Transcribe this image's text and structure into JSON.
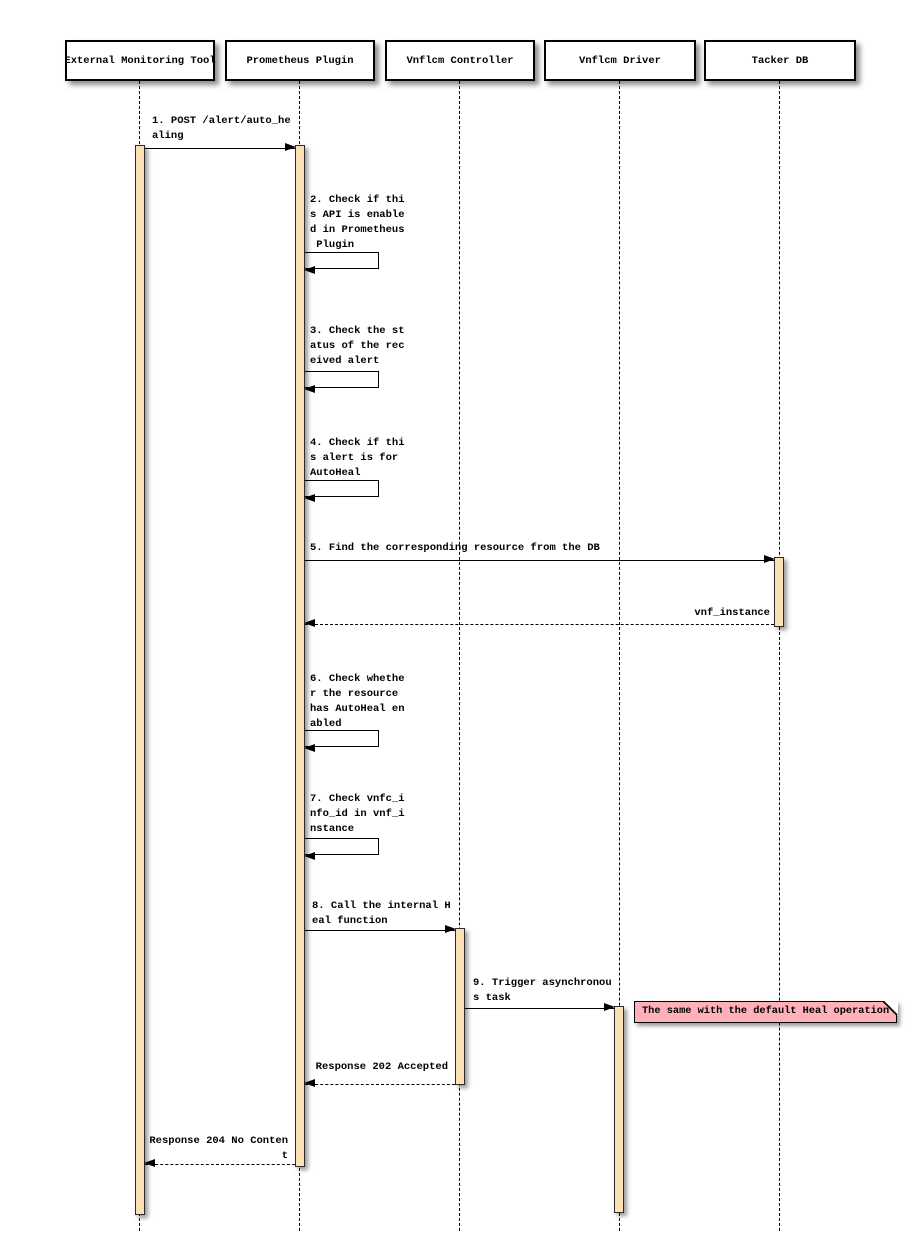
{
  "diagram_type": "uml-sequence-diagram",
  "participants": [
    {
      "label": "External Monitoring Tool"
    },
    {
      "label": "Prometheus Plugin"
    },
    {
      "label": "Vnflcm Controller"
    },
    {
      "label": "Vnflcm Driver"
    },
    {
      "label": "Tacker DB"
    }
  ],
  "messages": {
    "m1": {
      "from": "External Monitoring Tool",
      "to": "Prometheus Plugin",
      "type": "sync",
      "text": "1. POST /alert/auto_he\naling"
    },
    "m2": {
      "from": "Prometheus Plugin",
      "to": "Prometheus Plugin",
      "type": "self",
      "text": "2. Check if thi\ns API is enable\nd in Prometheus\n Plugin"
    },
    "m3": {
      "from": "Prometheus Plugin",
      "to": "Prometheus Plugin",
      "type": "self",
      "text": "3. Check the st\natus of the rec\neived alert"
    },
    "m4": {
      "from": "Prometheus Plugin",
      "to": "Prometheus Plugin",
      "type": "self",
      "text": "4. Check if thi\ns alert is for\nAutoHeal"
    },
    "m5": {
      "from": "Prometheus Plugin",
      "to": "Tacker DB",
      "type": "sync",
      "text": "5. Find the corresponding resource from the DB"
    },
    "m5r": {
      "from": "Tacker DB",
      "to": "Prometheus Plugin",
      "type": "return",
      "text": "vnf_instance"
    },
    "m6": {
      "from": "Prometheus Plugin",
      "to": "Prometheus Plugin",
      "type": "self",
      "text": "6. Check whethe\nr the resource\nhas AutoHeal en\nabled"
    },
    "m7": {
      "from": "Prometheus Plugin",
      "to": "Prometheus Plugin",
      "type": "self",
      "text": "7. Check vnfc_i\nnfo_id in vnf_i\nnstance"
    },
    "m8": {
      "from": "Prometheus Plugin",
      "to": "Vnflcm Controller",
      "type": "sync",
      "text": "8. Call the internal H\neal function"
    },
    "m9": {
      "from": "Vnflcm Controller",
      "to": "Vnflcm Driver",
      "type": "sync",
      "text": "9. Trigger asynchronou\ns task"
    },
    "r202": {
      "from": "Vnflcm Controller",
      "to": "Prometheus Plugin",
      "type": "return",
      "text": "Response 202 Accepted"
    },
    "r204": {
      "from": "Prometheus Plugin",
      "to": "External Monitoring Tool",
      "type": "return",
      "text": "Response 204 No Conten\nt"
    }
  },
  "note": {
    "attached_to": "Vnflcm Driver",
    "text": "The same with the default Heal operation"
  },
  "colors": {
    "background": "#FFFFFF",
    "participant_fill": "#FFFFFF",
    "participant_border": "#000000",
    "activation_fill": "#FBDFB5",
    "note_fill": "#FFB0B8",
    "line": "#000000"
  }
}
